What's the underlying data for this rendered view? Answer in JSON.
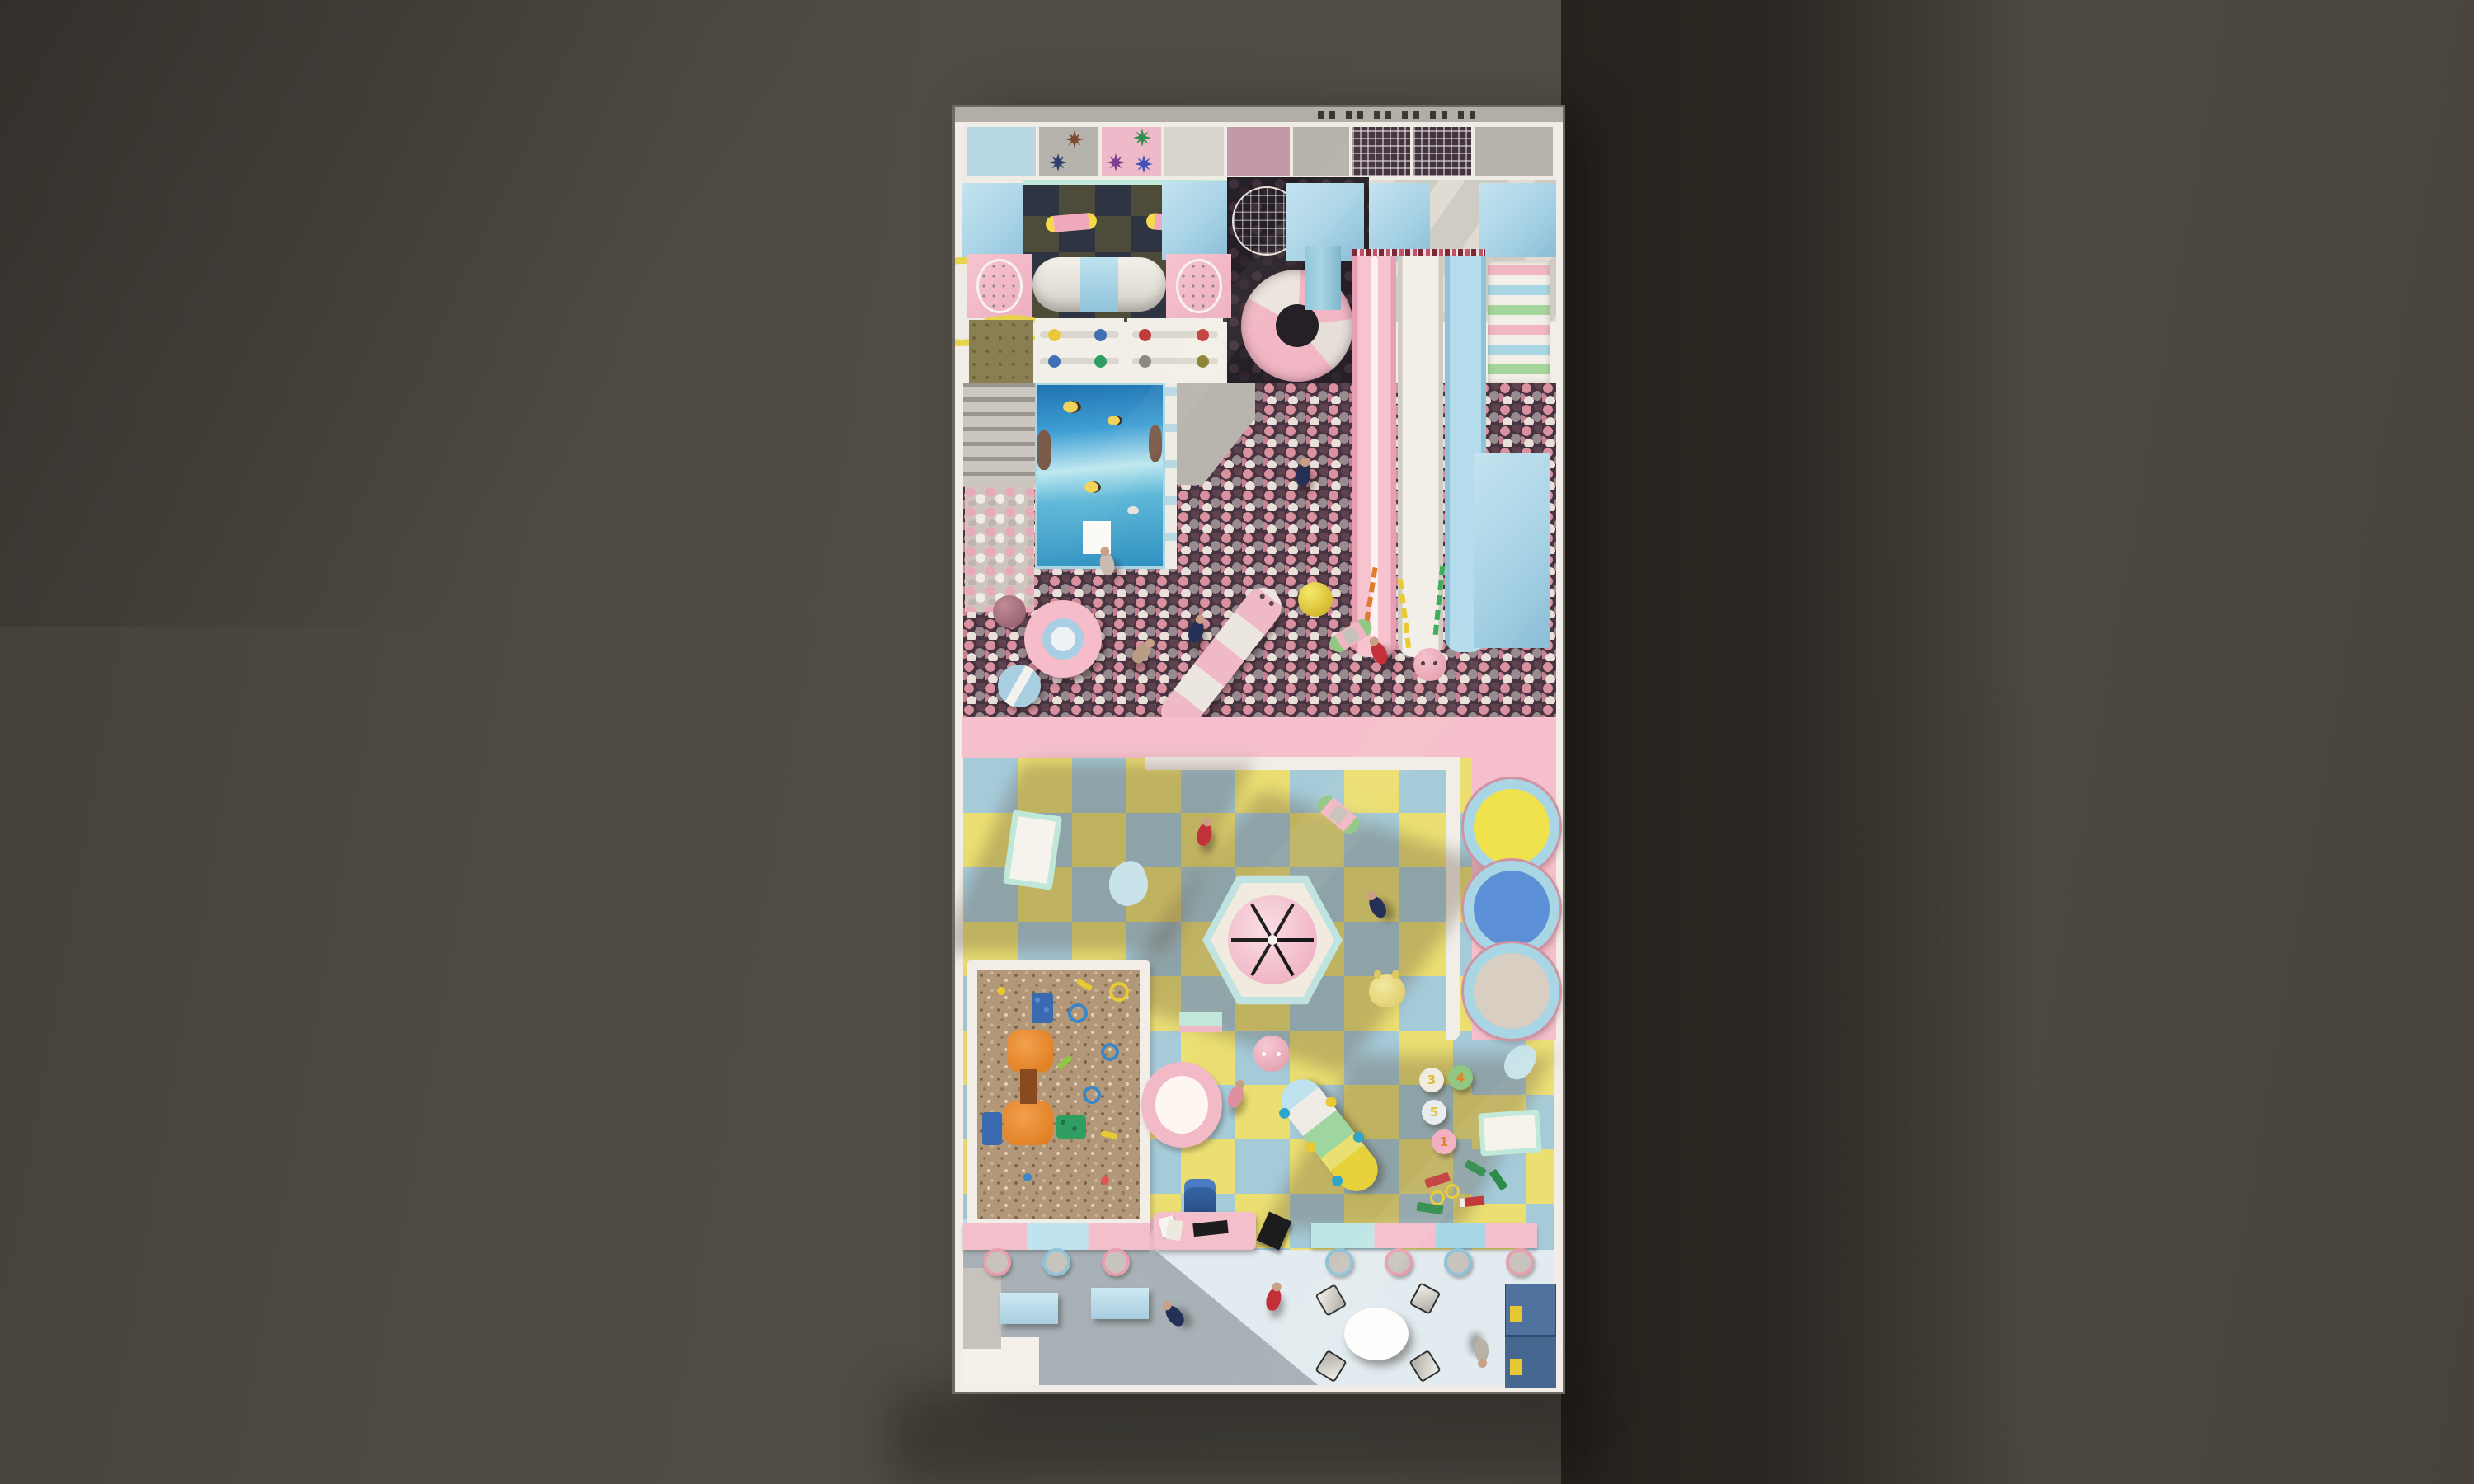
{
  "scene": {
    "kind": "top-down 3d render",
    "subject": "indoor kids playground floor plan",
    "background": {
      "base": "#4f4b44",
      "cast_shadow": "#2b2722"
    }
  },
  "palette": {
    "wall_cream": "#f2eee7",
    "pastel_blue": "#a8d3e6",
    "pastel_pink": "#f2bac6",
    "mint": "#bfe8d9",
    "checker_yellow": "#ebdf72",
    "checker_blue": "#a5cad8",
    "ballpit_base": "#483440",
    "ball_colors": [
      "#d9909f",
      "#978b90",
      "#e9e0da",
      "#5e434e"
    ],
    "sand": "#b29878",
    "lobby_floor": "#e2ebef"
  },
  "top_wall": {
    "vent_groups": 3
  },
  "panel_row": {
    "panels": [
      {
        "name": "blue-padding",
        "color": "#b7d8e3"
      },
      {
        "name": "spinner-panel-gray",
        "color": "#b6b2ac",
        "stars": [
          "#7a4a32",
          "#2e3f6e"
        ]
      },
      {
        "name": "spinner-panel-pink",
        "color": "#eeb9c8",
        "stars": [
          "#2f8f4e",
          "#7e3f8f",
          "#3f51b5"
        ]
      },
      {
        "name": "plain-light",
        "color": "#d8d4cd"
      },
      {
        "name": "mauve-panel",
        "color": "#c598a7"
      },
      {
        "name": "plain-gray",
        "color": "#b6b2ac"
      },
      {
        "name": "mesh-net",
        "color": "#41343d"
      },
      {
        "name": "mesh-net",
        "color": "#41343d"
      },
      {
        "name": "plain-gray",
        "color": "#b6b2ac"
      }
    ]
  },
  "structure_level": {
    "deck_checker": [
      "#4c4c38",
      "#2e3442"
    ],
    "cage_ball": "#1e181e",
    "spiral_slide": [
      "#f2b6c4",
      "#ece5de"
    ],
    "tunnel": {
      "body": "#f0ede6",
      "band": "#a9d6e4"
    },
    "roller_slide": [
      "#f2efe8",
      "#a5d69c",
      "#a9d6e4",
      "#f0b7c3",
      "#e8dc7a"
    ],
    "candy_stripe_bar": [
      "#7e2836",
      "#e8dede",
      "#c2526b"
    ],
    "slide_lanes": [
      {
        "name": "pink-slide",
        "color": "#f4bcc8"
      },
      {
        "name": "white-slide",
        "color": "#efeae2"
      },
      {
        "name": "blue-slide",
        "color": "#a9d6e4"
      }
    ],
    "shelf_dots": [
      "#e8c93c",
      "#3f6fb5",
      "#c23b3b",
      "#2f9e62",
      "#8d8881",
      "#8a7f2f"
    ],
    "ocean_wall": {
      "water": "#3f9fd4",
      "fish": "#f0d35a"
    }
  },
  "ball_pit": {
    "floats": {
      "donut": {
        "ring": "#f6bcca",
        "inner": "#a9cfe4",
        "center": "#eef2f4"
      },
      "drum": {
        "body": "#a9cfe0",
        "stripe": "#f2f2ef"
      },
      "dark_ball": "#a8717e",
      "caterpillar": [
        "#f0b9c6",
        "#ece6e0"
      ],
      "spiky_ball": "#e8d832",
      "face_ball": "#f0aebc"
    },
    "obstacle_ropes": [
      "#e07a2e",
      "#e8c932",
      "#3fae5c"
    ]
  },
  "toddler_area": {
    "frame_pink": "#f5c0cb",
    "carousel": {
      "base": "#bfe3e0",
      "dome": "#f5c7d3",
      "spokes": "#171717"
    },
    "trampolines": [
      {
        "name": "yellow-trampoline",
        "center": "#f0e24c"
      },
      {
        "name": "blue-trampoline",
        "center": "#5b8fd6"
      },
      {
        "name": "beige-trampoline",
        "center": "#d8cfc2"
      }
    ],
    "stepping_stones": [
      {
        "label": "3",
        "pad": "#f1ece2",
        "digit": "#e0b93a"
      },
      {
        "label": "4",
        "pad": "#8fc883",
        "digit": "#e0812e"
      },
      {
        "label": "5",
        "pad": "#e8eef0",
        "digit": "#e0c23a"
      },
      {
        "label": "1",
        "pad": "#f2afc0",
        "digit": "#e0812e"
      }
    ],
    "toys": {
      "cot": {
        "frame": "#bfe8d9",
        "mattress": "#f6f3ec"
      },
      "whale": "#c8e4ea",
      "seesaw": {
        "base": "#8fc883",
        "plank": "#f0b7c3"
      },
      "duck": "#e8d87a",
      "crawl_tunnel": [
        "#e8e070",
        "#9fd6a0",
        "#efece5",
        "#f2b9c6"
      ],
      "train_blocks": [
        "#2e8b4a",
        "#c23b3b",
        "#e8c932"
      ],
      "rocker": "#2f5fa8",
      "pink_ball": "#f0aebc"
    }
  },
  "sand_pit": {
    "frame": "#f2eee7",
    "table_set": {
      "tables": "#e8862a",
      "bench_blue": "#3a6ab0",
      "bench_green": "#2f9e62"
    },
    "toy_colors": [
      "#3a86c8",
      "#e8c932",
      "#2f9e62",
      "#e05454"
    ]
  },
  "lobby": {
    "wall_segments_left": [
      "#f3bfcb",
      "#bfe3ef",
      "#f3bfcb"
    ],
    "wall_segments_right": [
      "#bfe6e6",
      "#f3bfcb",
      "#a9d6e4",
      "#f3bfcb"
    ],
    "stool_rims": [
      "#e79fb0",
      "#8fc3d8"
    ],
    "desk": "#f3bfcb",
    "table": "#fdfdfb",
    "cabinet": {
      "body": "#50729e",
      "labels": "#e8c832"
    },
    "benches": "#bfe0ee",
    "mat": "#f4f1ea"
  },
  "people": {
    "count": 10,
    "shirt_colors": [
      "#243056",
      "#c4303a",
      "#b99c84",
      "#e08fa0"
    ]
  }
}
